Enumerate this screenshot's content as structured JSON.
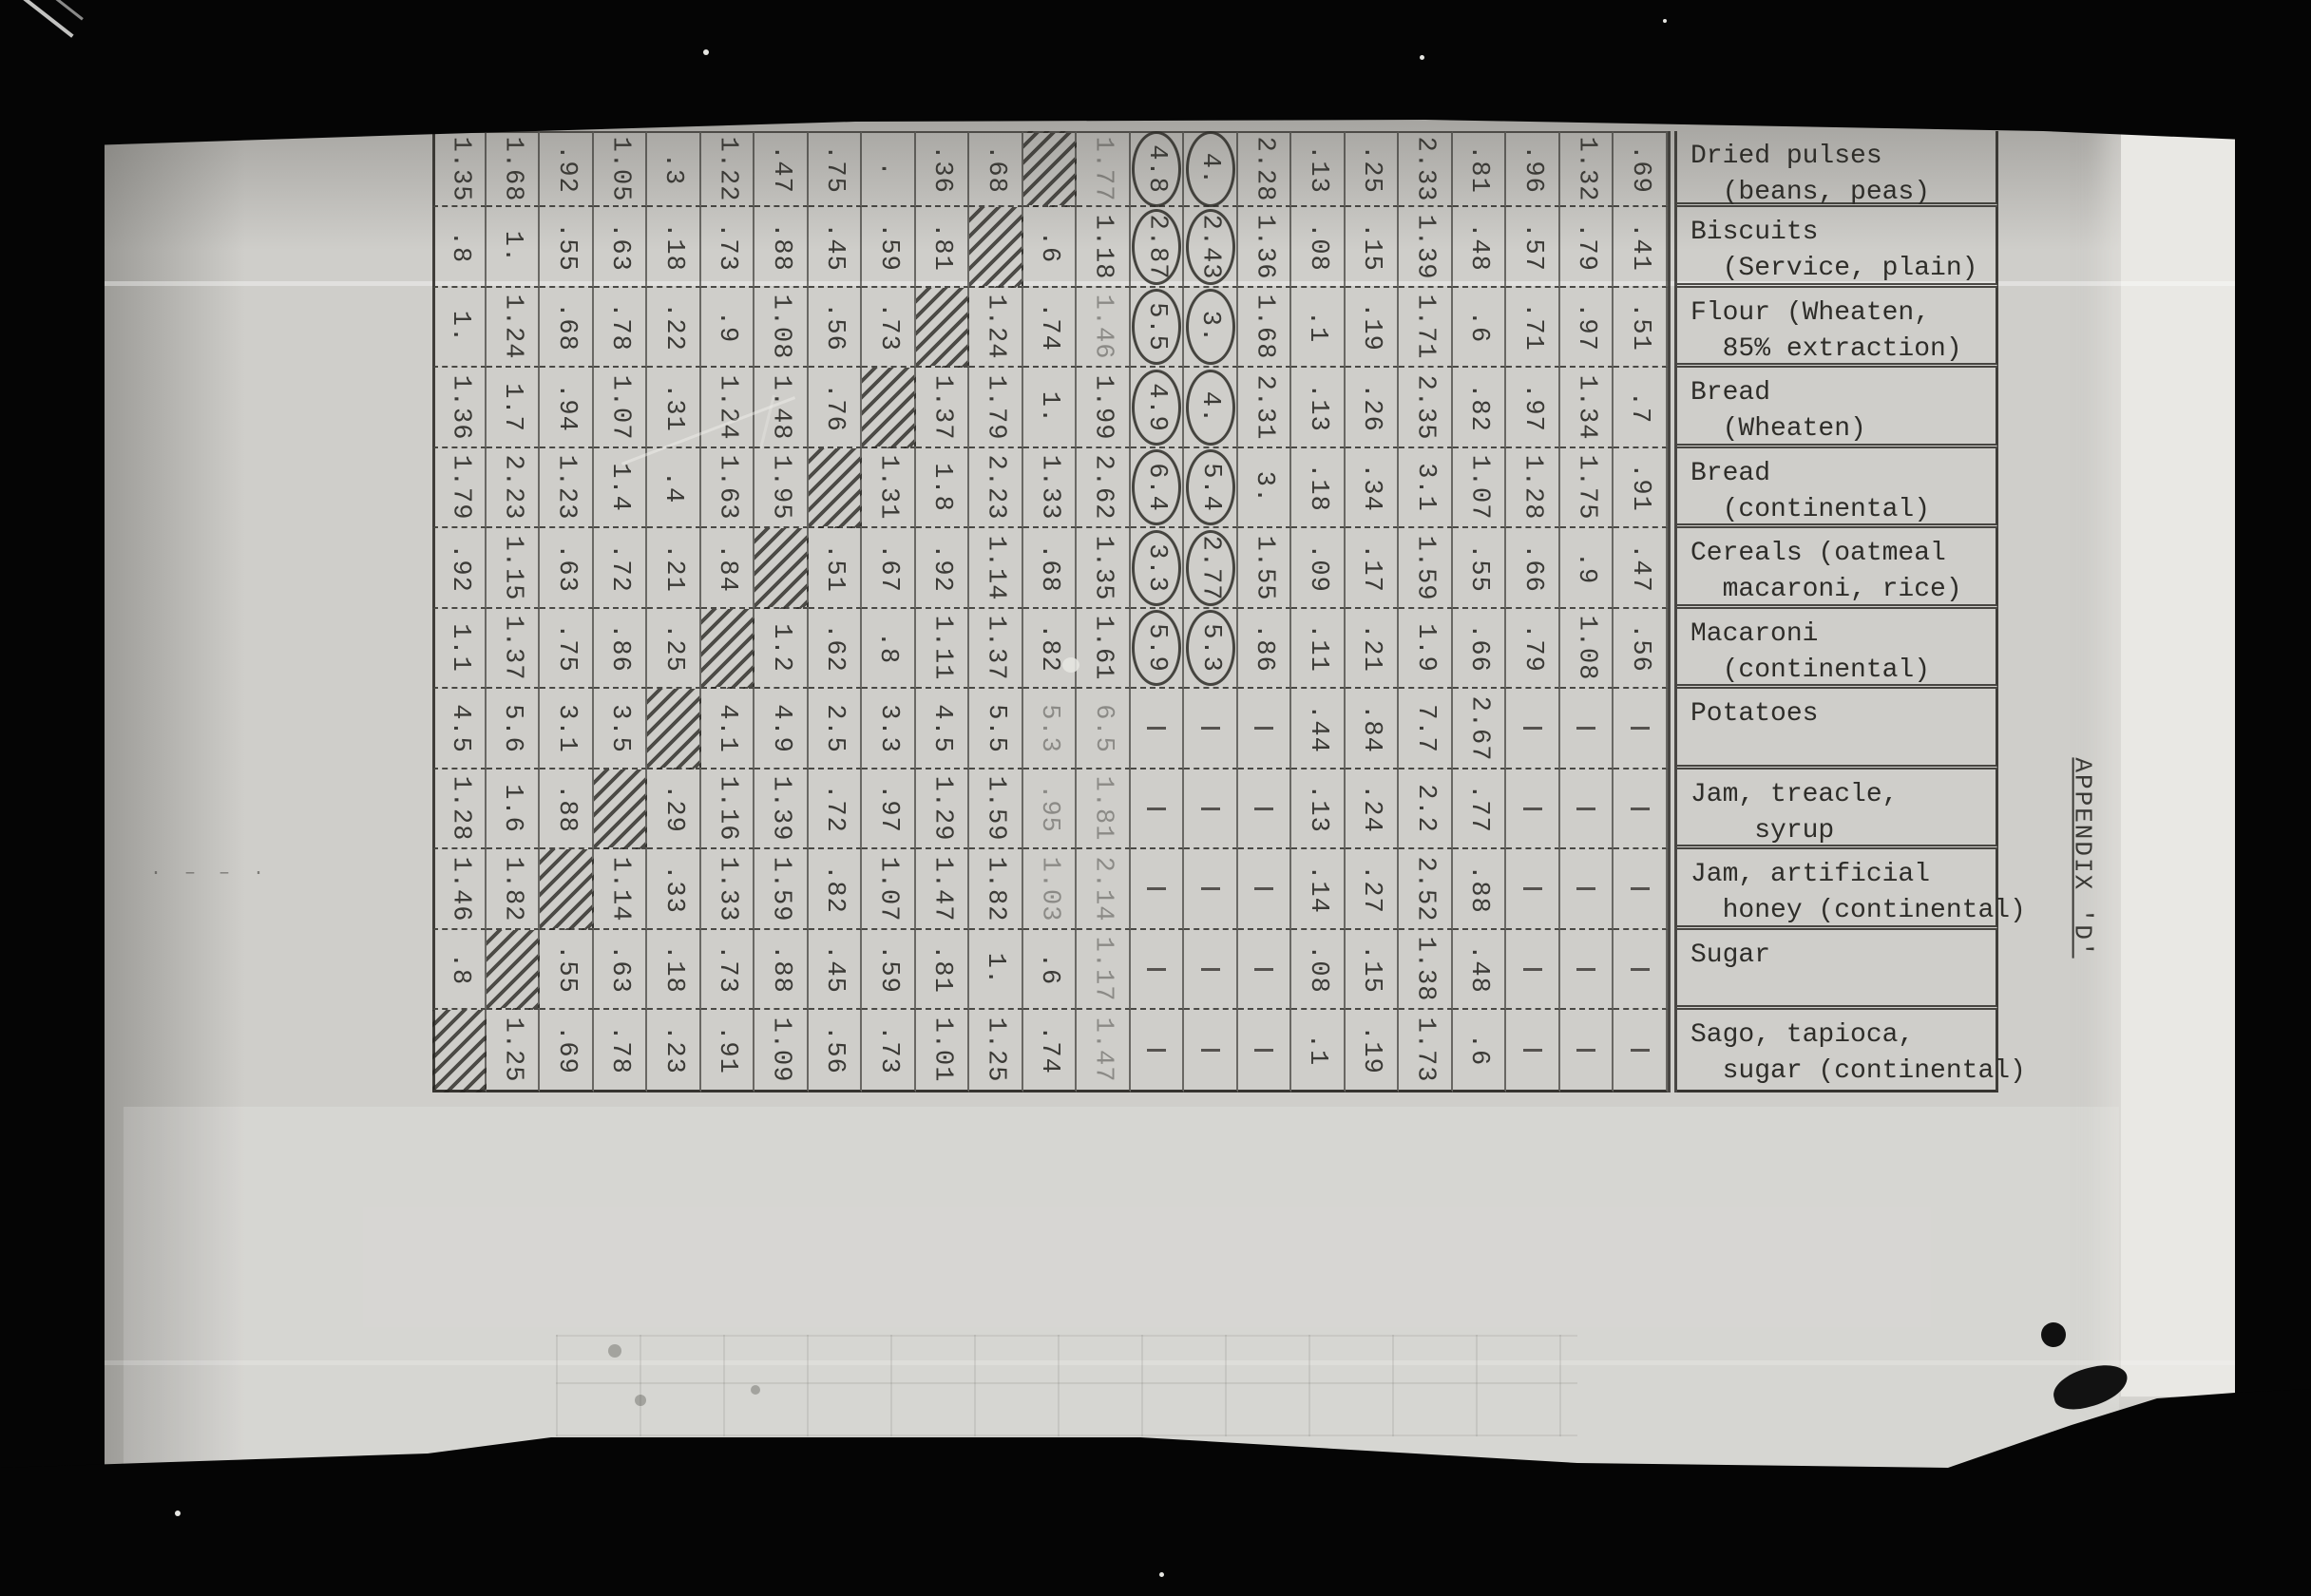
{
  "colors": {
    "paper": "#cfceca",
    "ink": "#3b3a36",
    "photo_background": "#060606"
  },
  "appendix_label": "APPENDIX 'D'",
  "table": {
    "rows": [
      {
        "label_line1": "Dried pulses",
        "label_line2": "  (beans, peas)",
        "cells": [
          "1.35",
          "1.68",
          ".92",
          "1.05",
          ".3",
          "1.22",
          ".47",
          ".75",
          ".",
          ".36",
          ".68",
          "#",
          "~1.77",
          "(4.8)",
          "(4.)",
          "2.28",
          ".13",
          ".25",
          "2.33",
          ".81",
          ".96",
          "1.32",
          ".69"
        ]
      },
      {
        "label_line1": "Biscuits",
        "label_line2": "  (Service, plain)",
        "cells": [
          ".8",
          "1.",
          ".55",
          ".63",
          ".18",
          ".73",
          ".88",
          ".45",
          ".59",
          ".81",
          "#",
          ".6",
          "1.18",
          "(2.87)",
          "(2.43)",
          "1.36",
          ".08",
          ".15",
          "1.39",
          ".48",
          ".57",
          ".79",
          ".41"
        ]
      },
      {
        "label_line1": "Flour (Wheaten,",
        "label_line2": "  85% extraction)",
        "cells": [
          "1.",
          "1.24",
          ".68",
          ".78",
          ".22",
          ".9",
          "1.08",
          ".56",
          ".73",
          "#",
          "1.24",
          ".74",
          "~1.46",
          "(5.5)",
          "(3.)",
          "1.68",
          ".1",
          ".19",
          "1.71",
          ".6",
          ".71",
          ".97",
          ".51"
        ]
      },
      {
        "label_line1": "Bread",
        "label_line2": "  (Wheaten)",
        "cells": [
          "1.36",
          "1.7",
          ".94",
          "1.07",
          ".31",
          "1.24",
          "1.48",
          ".76",
          "#",
          "1.37",
          "1.79",
          "1.",
          "1.99",
          "(4.9)",
          "(4.)",
          "2.31",
          ".13",
          ".26",
          "2.35",
          ".82",
          ".97",
          "1.34",
          ".7"
        ]
      },
      {
        "label_line1": "Bread",
        "label_line2": "  (continental)",
        "cells": [
          "1.79",
          "2.23",
          "1.23",
          "1.4",
          ".4",
          "1.63",
          "1.95",
          "#",
          "1.31",
          "1.8",
          "2.23",
          "1.33",
          "2.62",
          "(6.4)",
          "(5.4)",
          "3.",
          ".18",
          ".34",
          "3.1",
          "1.07",
          "1.28",
          "1.75",
          ".91"
        ]
      },
      {
        "label_line1": "Cereals (oatmeal",
        "label_line2": "  macaroni, rice)",
        "cells": [
          ".92",
          "1.15",
          ".63",
          ".72",
          ".21",
          ".84",
          "#",
          ".51",
          ".67",
          ".92",
          "1.14",
          ".68",
          "1.35",
          "(3.3)",
          "(2.77)",
          "1.55",
          ".09",
          ".17",
          "1.59",
          ".55",
          ".66",
          ".9",
          ".47"
        ]
      },
      {
        "label_line1": "Macaroni",
        "label_line2": "  (continental)",
        "cells": [
          "1.1",
          "1.37",
          ".75",
          ".86",
          ".25",
          "#",
          "1.2",
          ".62",
          ".8",
          "1.11",
          "1.37",
          ".82",
          "1.61",
          "(5.9)",
          "(5.3)",
          ".86",
          ".11",
          ".21",
          "1.9",
          ".66",
          ".79",
          "1.08",
          ".56"
        ]
      },
      {
        "label_line1": "Potatoes",
        "label_line2": "",
        "cells": [
          "4.5",
          "5.6",
          "3.1",
          "3.5",
          "#",
          "4.1",
          "4.9",
          "2.5",
          "3.3",
          "4.5",
          "5.5",
          "~5.3",
          "~6.5",
          "-",
          "-",
          "-",
          ".44",
          ".84",
          "7.7",
          "2.67",
          "-",
          "-",
          "-"
        ]
      },
      {
        "label_line1": "Jam, treacle,",
        "label_line2": "    syrup",
        "cells": [
          "1.28",
          "1.6",
          ".88",
          "#",
          ".29",
          "1.16",
          "1.39",
          ".72",
          ".97",
          "1.29",
          "1.59",
          "~.95",
          "~1.81",
          "-",
          "-",
          "-",
          ".13",
          ".24",
          "2.2",
          ".77",
          "-",
          "-",
          "-"
        ]
      },
      {
        "label_line1": "Jam, artificial",
        "label_line2": "  honey (continental)",
        "cells": [
          "1.46",
          "1.82",
          "#",
          "1.14",
          ".33",
          "1.33",
          "1.59",
          ".82",
          "1.07",
          "1.47",
          "1.82",
          "~1.03",
          "~2.14",
          "-",
          "-",
          "-",
          ".14",
          ".27",
          "2.52",
          ".88",
          "-",
          "-",
          "-"
        ]
      },
      {
        "label_line1": "Sugar",
        "label_line2": "",
        "cells": [
          ".8",
          "#",
          ".55",
          ".63",
          ".18",
          ".73",
          ".88",
          ".45",
          ".59",
          ".81",
          "1.",
          ".6",
          "~1.17",
          "-",
          "-",
          "-",
          ".08",
          ".15",
          "1.38",
          ".48",
          "-",
          "-",
          "-"
        ]
      },
      {
        "label_line1": "Sago, tapioca,",
        "label_line2": "  sugar (continental)",
        "cells": [
          "#",
          "1.25",
          ".69",
          ".78",
          ".23",
          ".91",
          "1.09",
          ".56",
          ".73",
          "1.01",
          "1.25",
          ".74",
          "~1.47",
          "-",
          "-",
          "-",
          ".1",
          ".19",
          "1.73",
          ".6",
          "-",
          "-",
          "-"
        ]
      }
    ]
  }
}
